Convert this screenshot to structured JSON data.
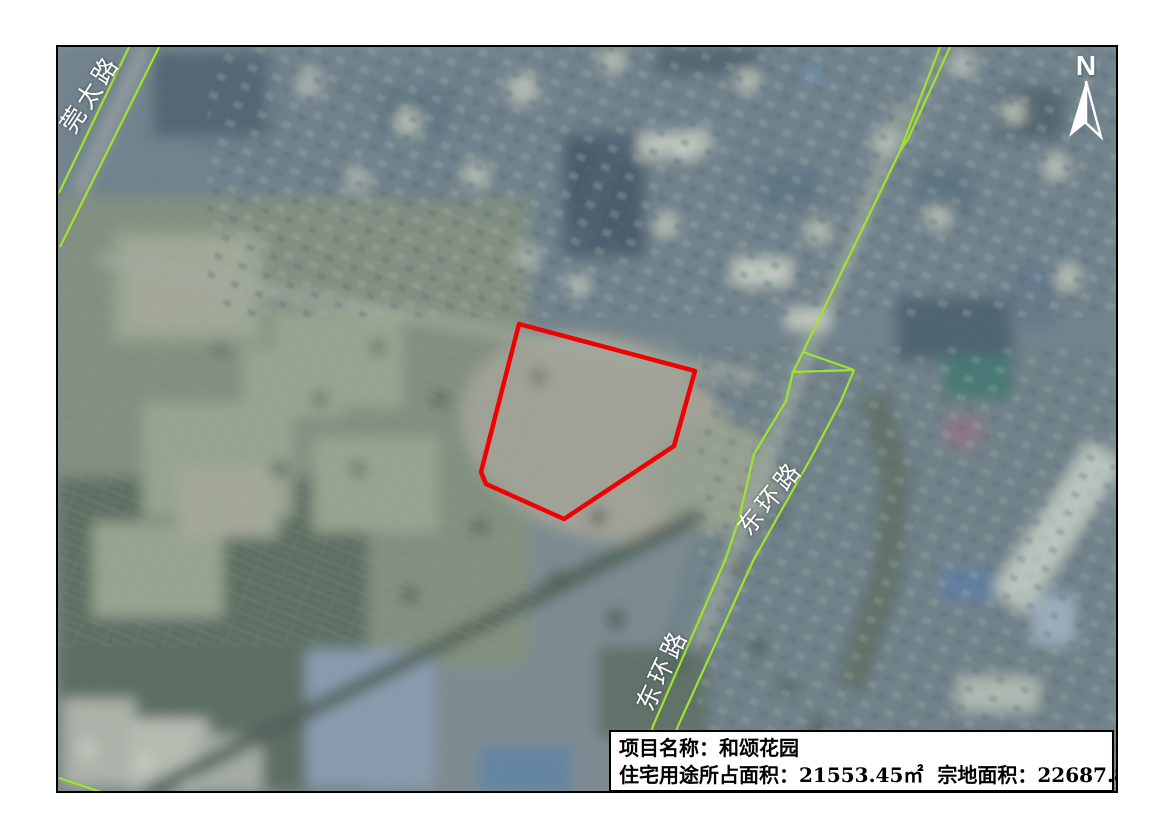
{
  "map": {
    "north_label": "N",
    "road_labels": [
      {
        "id": "guantai-road",
        "text": "莞太路"
      },
      {
        "id": "donghuan-road-upper",
        "text": "东环路"
      },
      {
        "id": "donghuan-road-lower",
        "text": "东环路"
      }
    ],
    "info_box": {
      "line1": {
        "label": "项目名称：",
        "value": "和颂花园"
      },
      "line2": {
        "residential_label": "住宅用途所占面积：",
        "residential_value": "21553.45㎡",
        "parcel_label": "宗地面积：",
        "parcel_value": "22687.84㎡"
      }
    },
    "colors": {
      "parcel_outline": "#f00000",
      "road_line": "#9fe42c",
      "label_text": "#ffffff",
      "north_arrow": "#ffffff",
      "info_box_bg": "#ffffff",
      "info_box_border": "#000000",
      "map_border": "#000000"
    },
    "overlays": {
      "parcel": {
        "closed": true,
        "stroke_width": 4.5,
        "points": [
          [
            461,
            277
          ],
          [
            637,
            324
          ],
          [
            616,
            399
          ],
          [
            506,
            472
          ],
          [
            428,
            437
          ],
          [
            423,
            425
          ]
        ]
      },
      "green_lines": [
        [
          [
            71,
            0
          ],
          [
            1,
            146
          ]
        ],
        [
          [
            101,
            0
          ],
          [
            2,
            200
          ]
        ],
        [
          [
            1,
            731
          ],
          [
            46,
            746
          ]
        ],
        [
          [
            882,
            0
          ],
          [
            842,
            104
          ]
        ],
        [
          [
            892,
            0
          ],
          [
            850,
            92
          ],
          [
            842,
            104
          ]
        ],
        [
          [
            842,
            104
          ],
          [
            745,
            305
          ]
        ],
        [
          [
            745,
            305
          ],
          [
            796,
            323
          ],
          [
            735,
            325
          ],
          [
            745,
            305
          ]
        ],
        [
          [
            735,
            325
          ],
          [
            728,
            354
          ],
          [
            696,
            407
          ],
          [
            681,
            472
          ],
          [
            668,
            511
          ],
          [
            595,
            679
          ],
          [
            592,
            690
          ]
        ],
        [
          [
            796,
            323
          ],
          [
            783,
            354
          ],
          [
            753,
            411
          ],
          [
            723,
            464
          ],
          [
            695,
            514
          ],
          [
            620,
            679
          ],
          [
            616,
            690
          ]
        ]
      ]
    }
  }
}
